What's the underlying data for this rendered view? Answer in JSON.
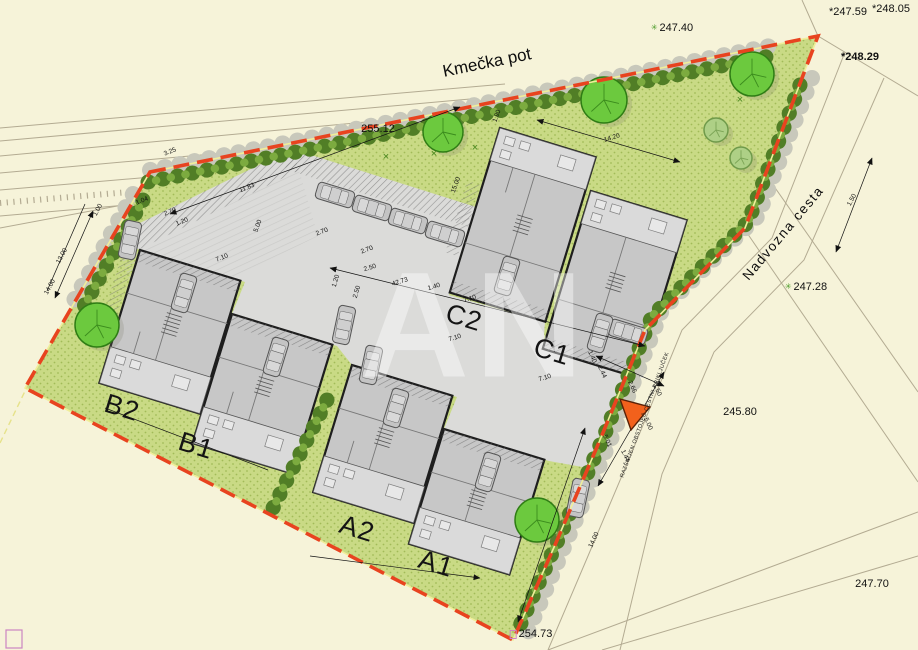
{
  "streets": {
    "top_label": "Kmečka pot",
    "right_label": "Nadvozna cesta"
  },
  "road_note": {
    "text": "RAZŠIRJEN OBSTOJEČ CESTNI PRIKLJUČEK"
  },
  "watermark": {
    "text": "AN"
  },
  "building_labels": [
    [
      "B2",
      122,
      408
    ],
    [
      "B1",
      196,
      446
    ],
    [
      "C2",
      464,
      318
    ],
    [
      "C1",
      552,
      352
    ],
    [
      "A2",
      357,
      529
    ],
    [
      "A1",
      436,
      564
    ]
  ],
  "elevation_labels": [
    {
      "text": "247.40",
      "x": 672,
      "y": 28,
      "marker": "plant"
    },
    {
      "text": "*247.59",
      "x": 848,
      "y": 12
    },
    {
      "text": "*248.05",
      "x": 891,
      "y": 9
    },
    {
      "text": "*248.29",
      "x": 860,
      "y": 57,
      "bold": true
    },
    {
      "text": "255.12",
      "x": 378,
      "y": 129
    },
    {
      "text": "247.28",
      "x": 806,
      "y": 287,
      "marker": "plant"
    },
    {
      "text": "245.80",
      "x": 740,
      "y": 412
    },
    {
      "text": "247.70",
      "x": 872,
      "y": 584
    },
    {
      "text": "254.73",
      "x": 531,
      "y": 634,
      "marker": "box"
    }
  ],
  "dimension_labels": [
    [
      "1.00",
      98,
      210,
      -62
    ],
    [
      "13.00",
      62,
      256,
      -62
    ],
    [
      "14.00",
      50,
      287,
      -62
    ],
    [
      "3.25",
      170,
      152,
      -22
    ],
    [
      "1.04",
      142,
      201,
      -22
    ],
    [
      "2.70",
      170,
      212,
      -22
    ],
    [
      "1.20",
      182,
      222,
      -22
    ],
    [
      "11.83",
      247,
      188,
      -22
    ],
    [
      "7.10",
      222,
      258,
      -22
    ],
    [
      "5.00",
      258,
      226,
      -70
    ],
    [
      "2.70",
      322,
      232,
      -20
    ],
    [
      "2.70",
      367,
      250,
      -20
    ],
    [
      "2.50",
      370,
      268,
      -17
    ],
    [
      "42.73",
      400,
      282,
      -17
    ],
    [
      "1.40",
      434,
      287,
      -17
    ],
    [
      "7.10",
      470,
      299,
      -17
    ],
    [
      "7.10",
      455,
      338,
      -17
    ],
    [
      "7.10",
      545,
      378,
      -17
    ],
    [
      "1.20",
      336,
      281,
      -73
    ],
    [
      "2.50",
      357,
      292,
      -73
    ],
    [
      "14.20",
      612,
      138,
      -17
    ],
    [
      "1.90",
      497,
      116,
      -70
    ],
    [
      "15.00",
      456,
      185,
      -70
    ],
    [
      "1.40",
      592,
      357,
      65
    ],
    [
      "2.44",
      602,
      372,
      65
    ],
    [
      "2.66",
      632,
      387,
      65
    ],
    [
      "1.50",
      657,
      390,
      65
    ],
    [
      "5.00",
      648,
      424,
      65
    ],
    [
      "1.44",
      625,
      456,
      65
    ],
    [
      "5.01",
      607,
      441,
      65
    ],
    [
      "1.50",
      852,
      200,
      -62
    ],
    [
      "14.00",
      594,
      540,
      -65
    ]
  ],
  "landscape": {
    "x_symbol": "×",
    "x_marks": [
      [
        386,
        160
      ],
      [
        434,
        157
      ],
      [
        475,
        151
      ],
      [
        740,
        103
      ],
      [
        790,
        112
      ]
    ],
    "trees": [
      [
        97,
        325,
        22,
        1
      ],
      [
        443,
        132,
        20,
        1
      ],
      [
        604,
        100,
        23,
        1
      ],
      [
        752,
        74,
        22,
        1
      ],
      [
        716,
        130,
        12,
        0
      ],
      [
        741,
        158,
        11,
        0
      ],
      [
        537,
        520,
        22,
        1
      ]
    ],
    "hedges": [
      {
        "d": "M148,182 L770,56",
        "shadow": "M150,170 L780,44"
      },
      {
        "d": "M800,85 L748,222 L652,316 L604,436 L558,540 L518,630",
        "shadow": "M812,78 L758,216 L662,310 L614,432 L568,538 L528,632"
      },
      {
        "d": "M143,200 L83,308",
        "shadow": "M133,194 L73,302"
      },
      {
        "d": "M327,400 L273,508",
        "shadow": ""
      }
    ]
  },
  "vehicles": {
    "cars": [
      [
        130,
        240,
        12
      ],
      [
        335,
        195,
        107
      ],
      [
        372,
        208,
        107
      ],
      [
        408,
        221,
        107
      ],
      [
        445,
        234,
        107
      ],
      [
        344,
        325,
        12
      ],
      [
        371,
        365,
        12
      ],
      [
        578,
        498,
        12
      ],
      [
        628,
        332,
        107
      ],
      [
        184,
        293,
        17
      ],
      [
        276,
        357,
        17
      ],
      [
        396,
        408,
        17
      ],
      [
        488,
        472,
        17
      ],
      [
        507,
        276,
        17
      ],
      [
        600,
        333,
        17
      ]
    ]
  },
  "colors": {
    "boundary": "#e8431f",
    "green": "#c9da85",
    "green_dot": "#a2bb58",
    "pavement": "#dbdbd9",
    "cream": "#f6f3d9",
    "tree_bright": "#6cc93e",
    "tree_pale": "#aed086",
    "hedge": "#517e26",
    "triangle": "#f2611c"
  }
}
